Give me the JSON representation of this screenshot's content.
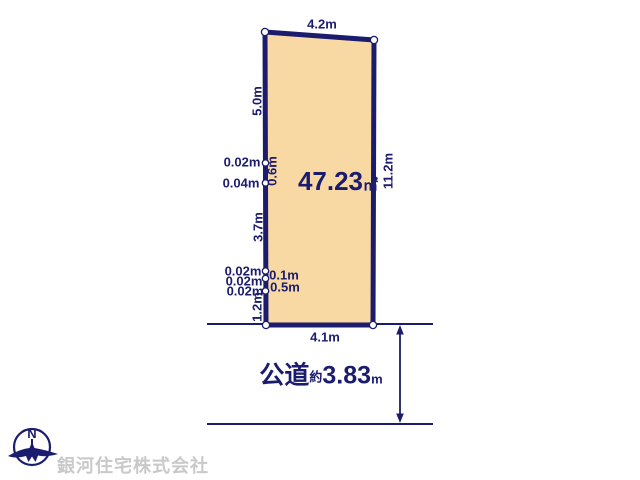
{
  "title": "land-plot-diagram",
  "colors": {
    "line": "#1c1c6e",
    "parcel_fill": "#f8d9a3",
    "watermark": "#c9c9c9",
    "background": "#ffffff"
  },
  "parcel": {
    "area": {
      "value": "47.23",
      "unit": "㎡"
    },
    "edges": {
      "top": "4.2m",
      "bottom": "4.1m",
      "right": "11.2m",
      "left_upper": "5.0m",
      "left_seg_06": "0.6m",
      "left_mid": "3.7m",
      "left_seg_01": "0.1m",
      "left_seg_05": "0.5m",
      "left_lower": "1.2m"
    },
    "boundary_offsets": {
      "o1": "0.02m",
      "o2": "0.04m",
      "o3": "0.02m",
      "o4": "0.02m",
      "o5": "0.02m"
    }
  },
  "road": {
    "type_label": "公道",
    "approx_label": "約",
    "width_value": "3.83",
    "width_unit": "m"
  },
  "compass": {
    "north_label": "N"
  },
  "company_watermark": "銀河住宅株式会社"
}
